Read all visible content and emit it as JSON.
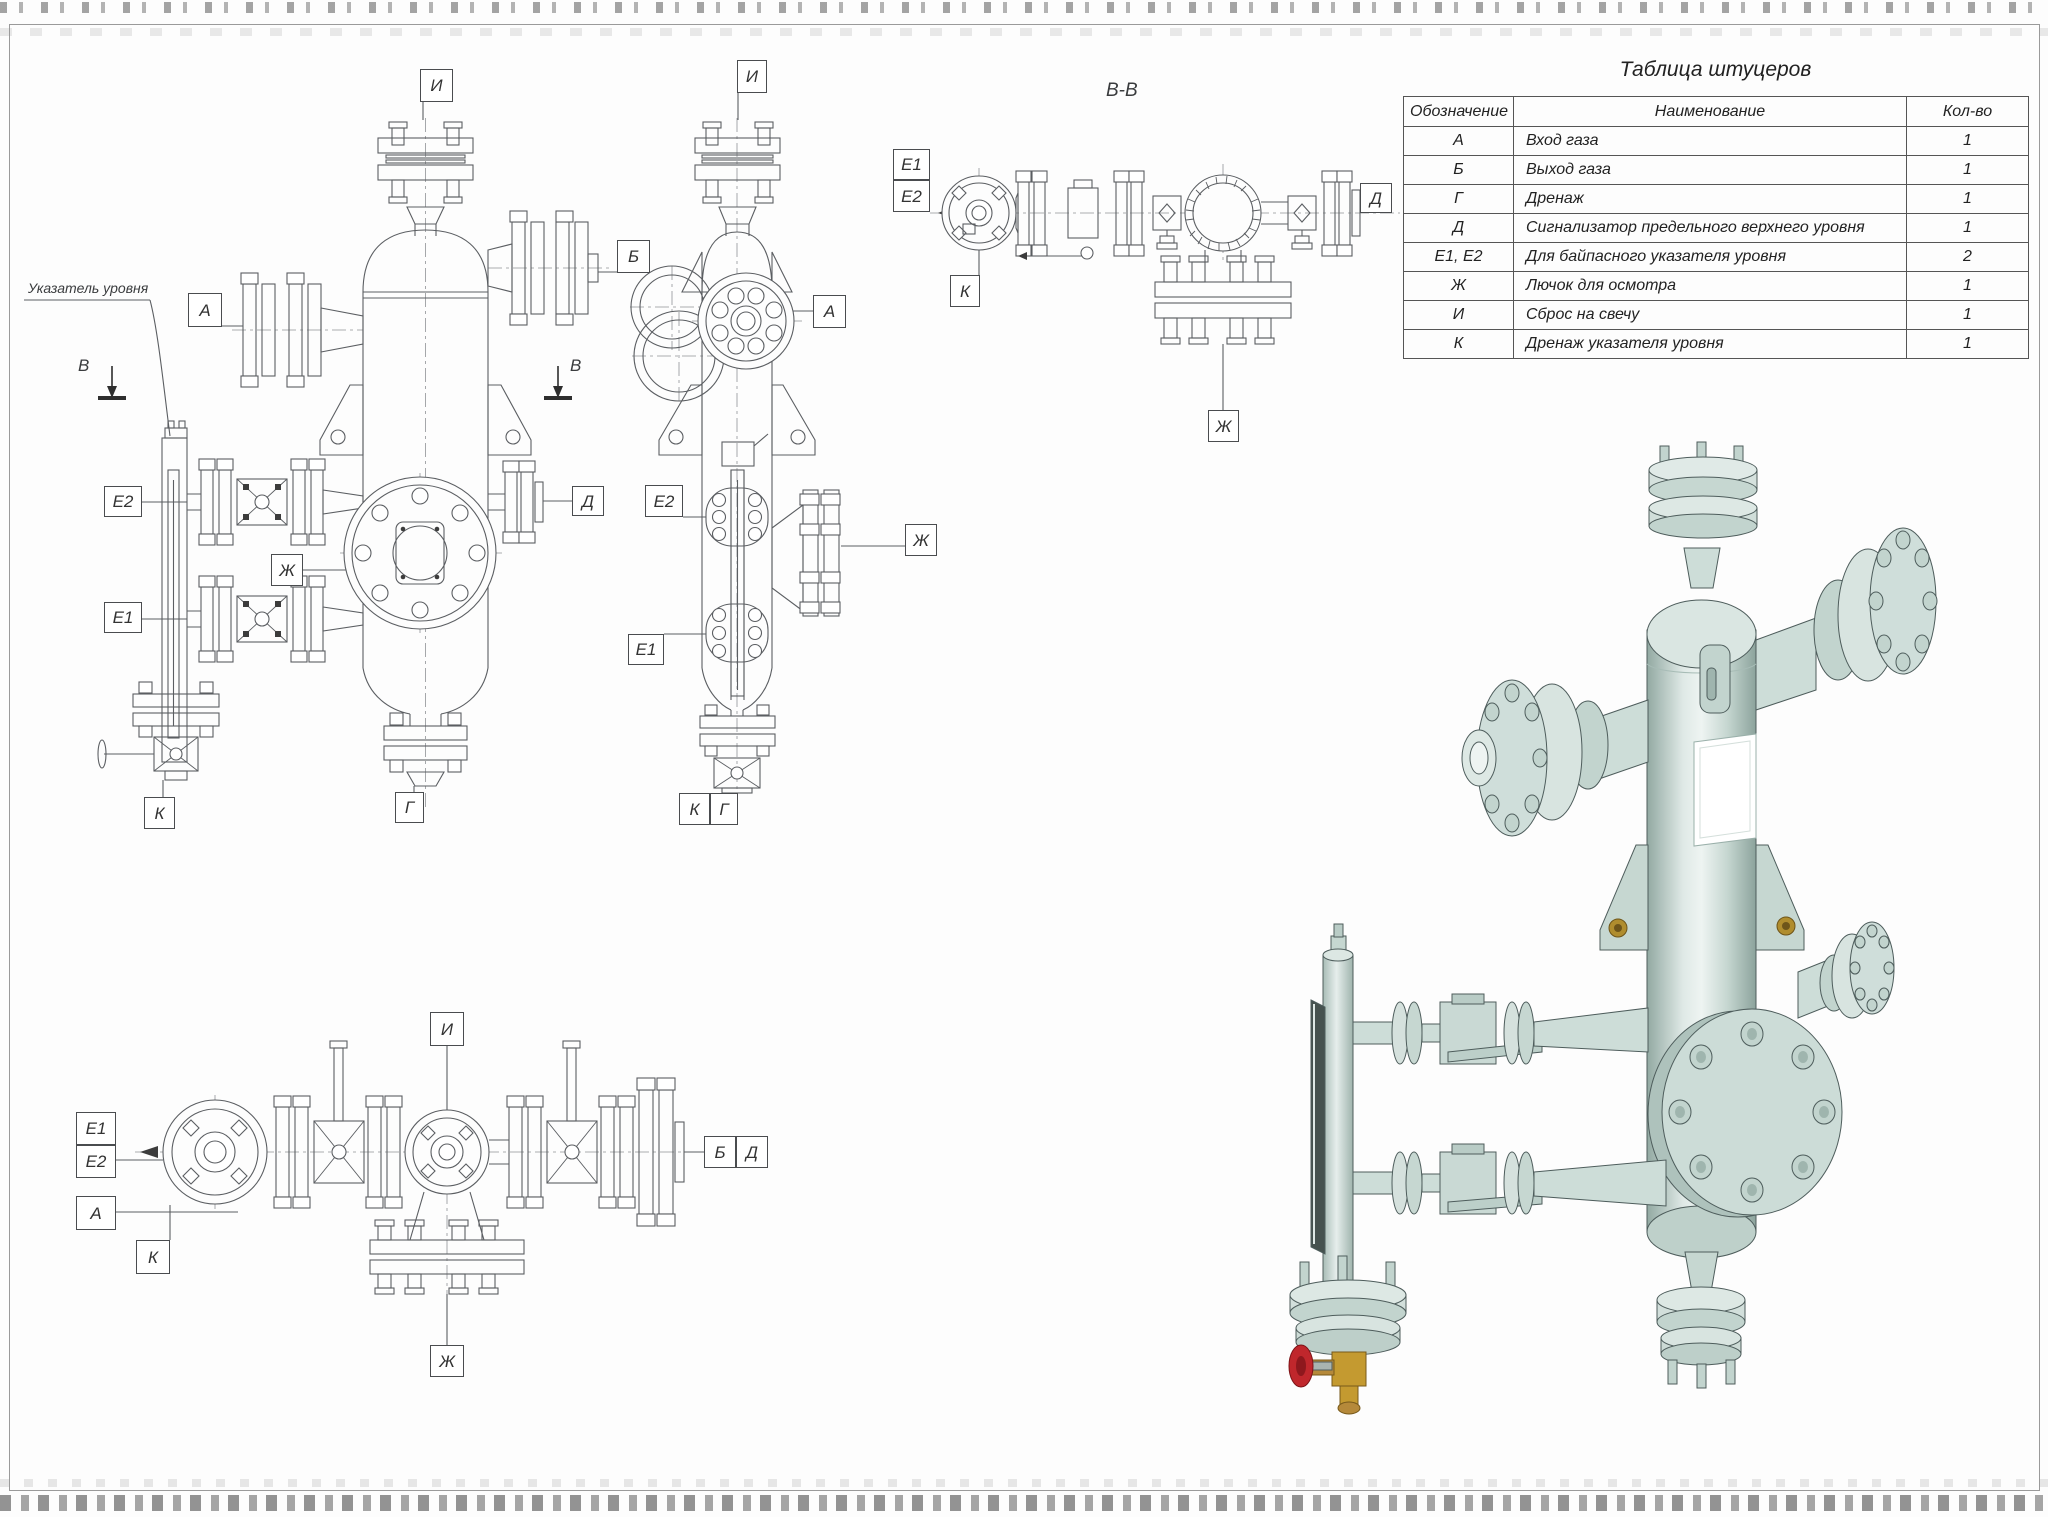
{
  "table": {
    "title": "Таблица штуцеров",
    "headers": [
      "Обозначение",
      "Наименование",
      "Кол-во"
    ],
    "rows": [
      [
        "А",
        "Вход газа",
        "1"
      ],
      [
        "Б",
        "Выход газа",
        "1"
      ],
      [
        "Г",
        "Дренаж",
        "1"
      ],
      [
        "Д",
        "Сигнализатор предельного верхнего уровня",
        "1"
      ],
      [
        "Е1, Е2",
        "Для байпасного указателя уровня",
        "2"
      ],
      [
        "Ж",
        "Лючок для осмотра",
        "1"
      ],
      [
        "И",
        "Сброс на свечу",
        "1"
      ],
      [
        "К",
        "Дренаж указателя уровня",
        "1"
      ]
    ]
  },
  "labels": {
    "section_title": "В-В",
    "gauge_note": "Указатель уровня",
    "section_letter": "В",
    "front": [
      "И",
      "Б",
      "А",
      "Е2",
      "Д",
      "Ж",
      "Е1",
      "К",
      "Г"
    ],
    "side": [
      "И",
      "А",
      "Е2",
      "Ж",
      "Е1",
      "К",
      "Г"
    ],
    "section": [
      "Е1",
      "Е2",
      "Д",
      "К",
      "Ж"
    ],
    "plan": [
      "И",
      "Е1",
      "Е2",
      "А",
      "Б",
      "Д",
      "К",
      "Ж"
    ]
  },
  "colors": {
    "line": "#5b5e62",
    "body_light": "#e7efec",
    "body_mid": "#cdddd8",
    "body_dark": "#93aaa3",
    "brass": "#c49a30",
    "red_handwheel": "#c0272c"
  }
}
